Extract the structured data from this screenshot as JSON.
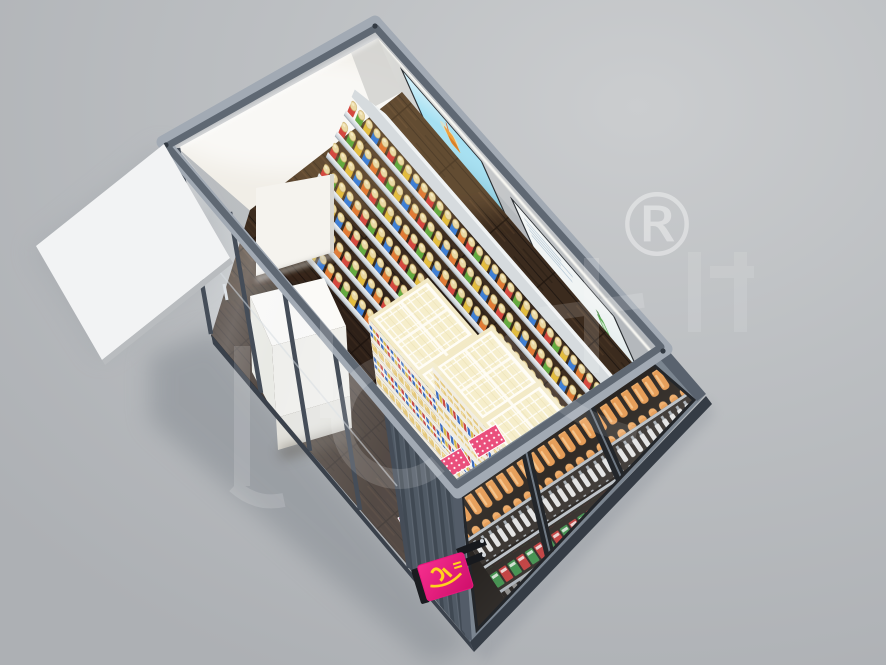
{
  "image": {
    "width": 886,
    "height": 665,
    "description": "3D render: aerial cutaway view of a shipping-container convenience store with roof removed"
  },
  "watermark": {
    "registered_symbol": "®"
  },
  "colors": {
    "background": "#bcbfc2",
    "frame_light": "#a2aab4",
    "frame_dark": "#5f6873",
    "exterior_wall": "#515a66",
    "base_rail": "#3a414b",
    "interior_wall": "#f1eee7",
    "ne_wall": "#c6c8ca",
    "floor_wood": "#3b2b1e",
    "screen1": "#a5e0f2",
    "screen2": "#f0f4f4",
    "awning": "#f2f3f4",
    "glass_tint": "rgba(236,241,246,0.16)",
    "island_cream": "#f3ebc6",
    "tray_pink": "#ea4f7c",
    "bottle_orange": "#e59a52",
    "sign_pink": "#e8187c",
    "sign_yellow": "#ffd21e",
    "shelf_product_colors": [
      "#d4483f",
      "#63a93f",
      "#e3bc3f",
      "#3f7fd4",
      "#e07a35"
    ]
  },
  "scene": {
    "objects": [
      "awning",
      "entrance-glass-wall",
      "checkout-counter",
      "partition-wall",
      "wall-shelving-with-products",
      "tv-screen-drink-ad",
      "tv-screen-bottle-ad",
      "display-island-1",
      "display-island-2",
      "pink-gift-trays",
      "glass-door-drink-fridge",
      "brand-sign"
    ]
  }
}
